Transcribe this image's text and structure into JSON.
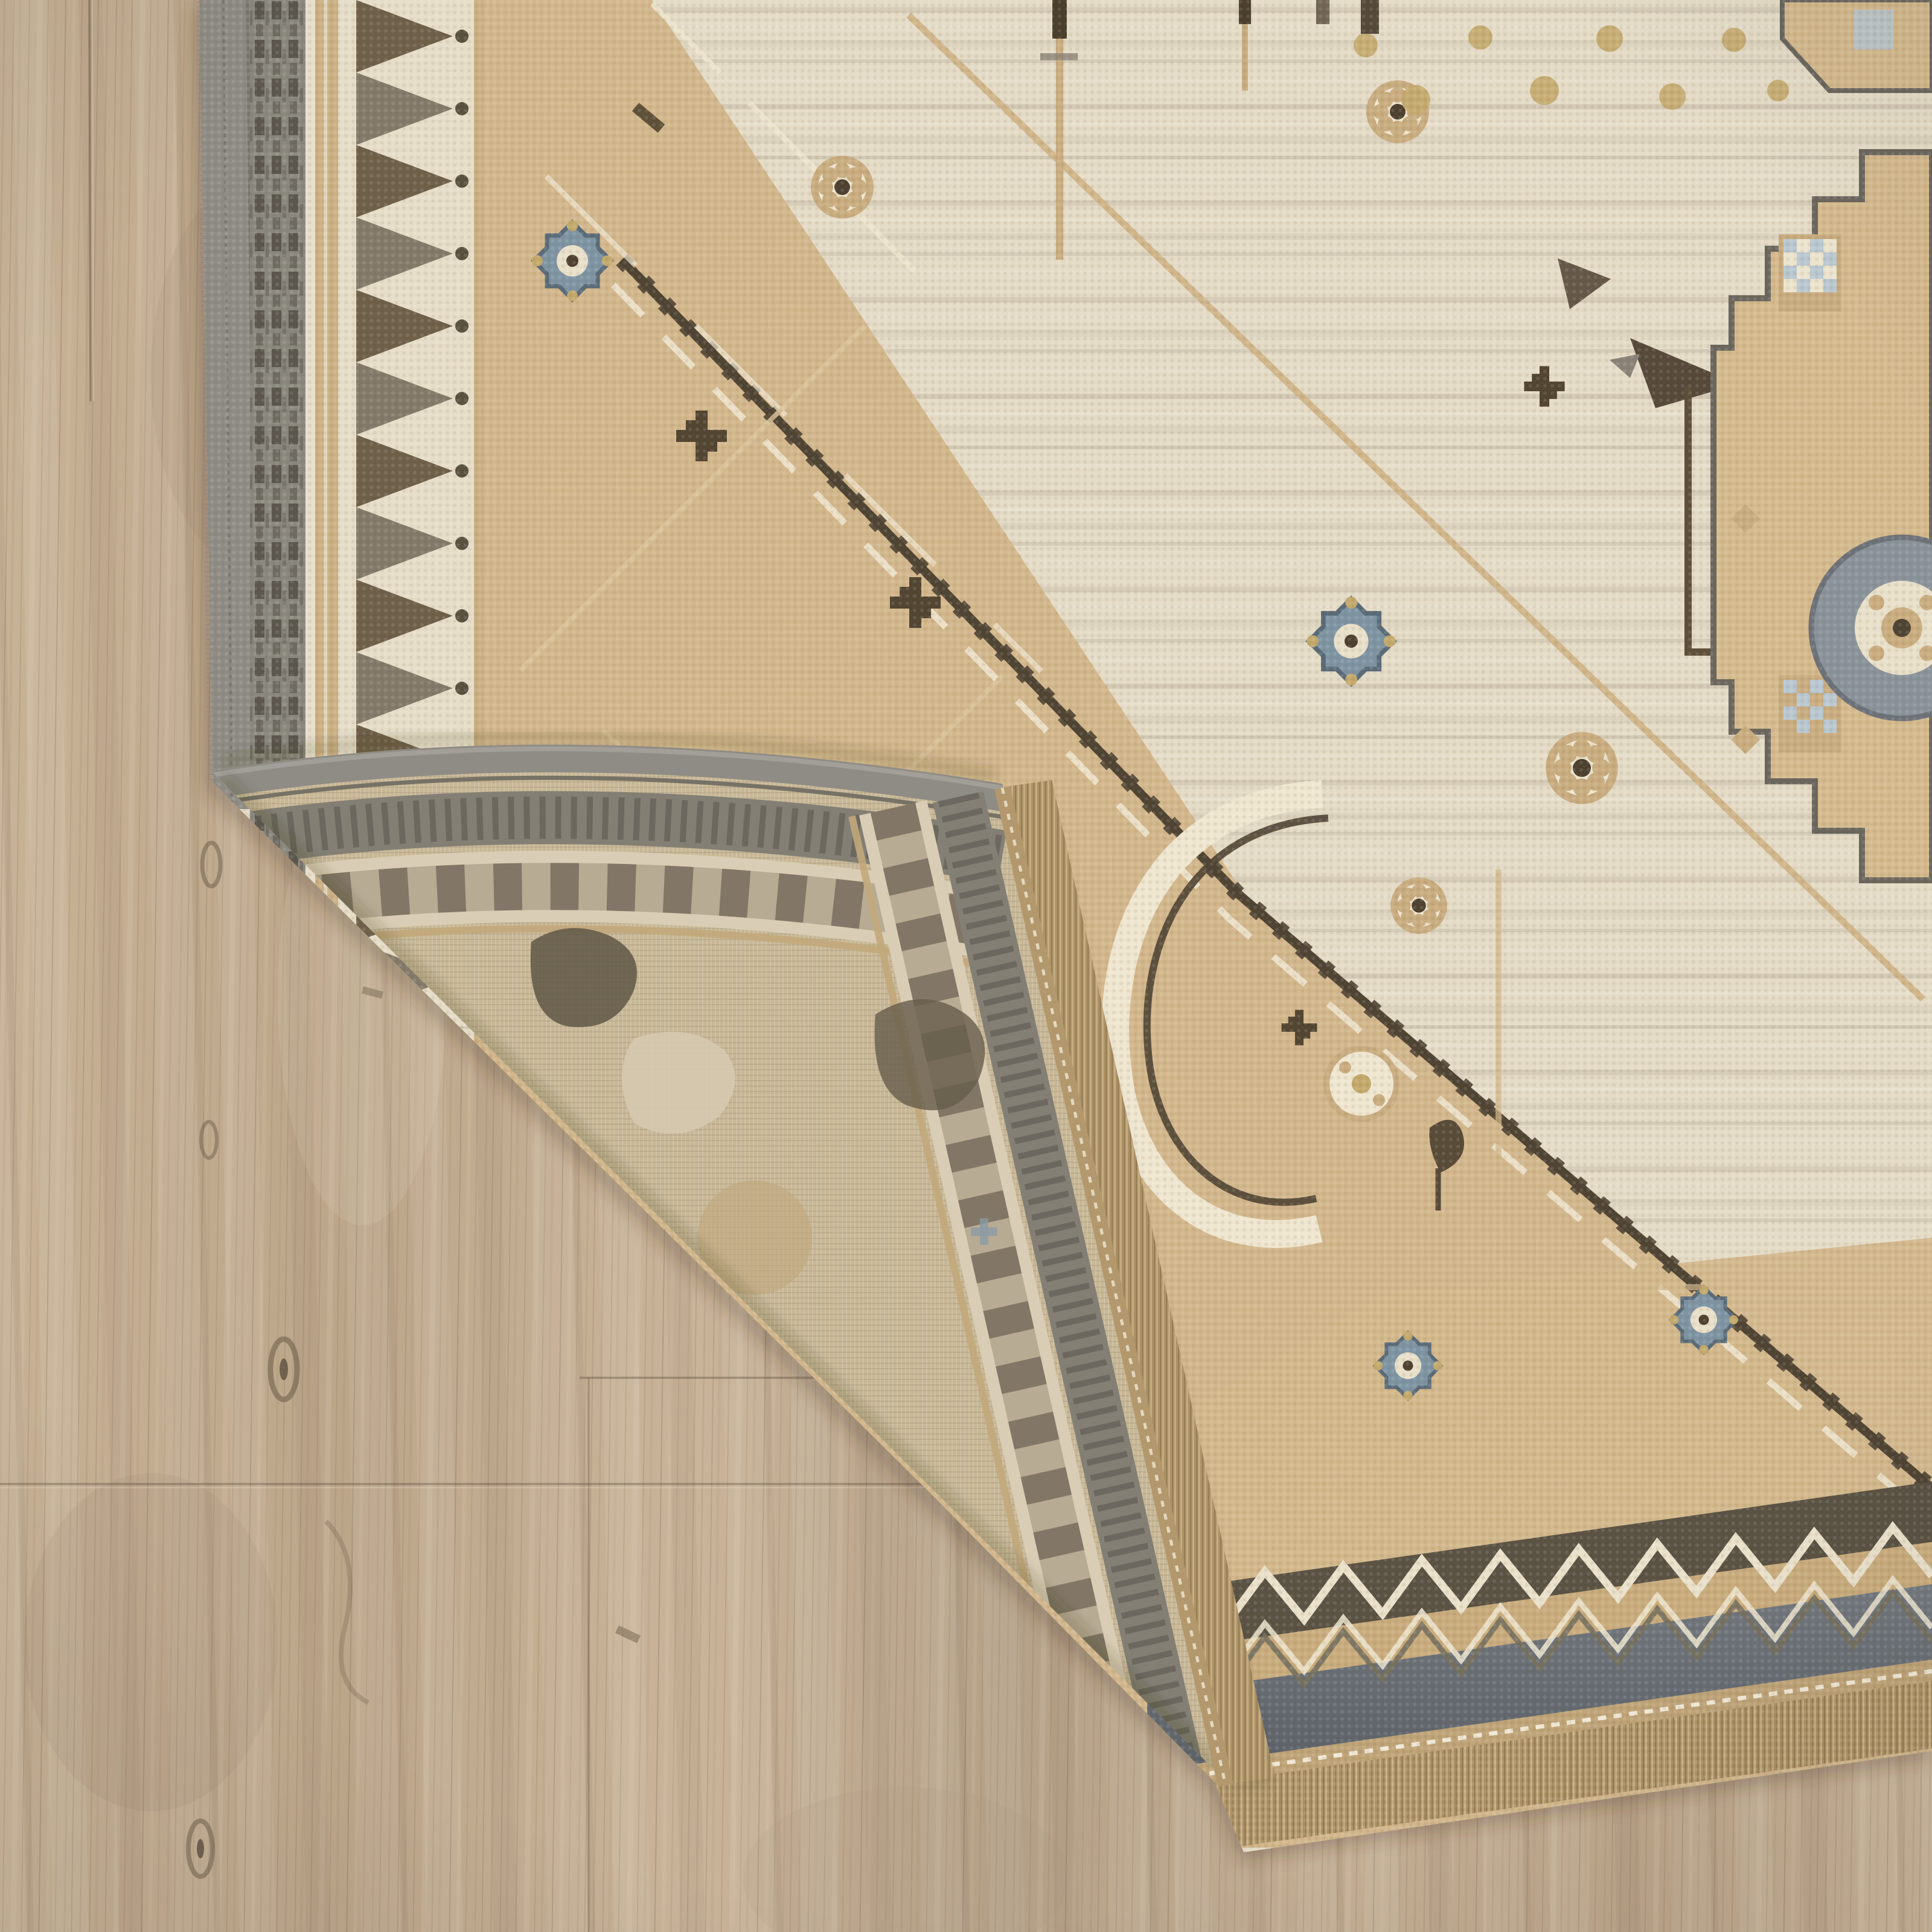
{
  "scene": {
    "type": "product-photograph",
    "subject": "Beige ivory and tan oriental area rug with bottom-left corner folded over, revealing muted reverse weave, gray serged edge and tan fringe, on a light oak wood plank floor",
    "caption": "Rug corner folded showing front pile, woven back, serged side edge and fringed end over wood flooring",
    "rug": {
      "front_face": "knotted pile, ivory field with tan diagonal bands, brown zigzag diagonals, rosette and bird-on-pole motifs, stepped tan medallion at right edge",
      "back_face": "flat muted weave of same border pattern on folded corner",
      "side_edge": "gray serged binding",
      "end_edge": "tan selvage with white stitch dots and tan fringe",
      "borders": [
        "gray striped outer band",
        "ivory band with brown triangle zigzag",
        "slate gray band",
        "dark band with ivory chevron"
      ]
    },
    "floor": {
      "material": "light oak style planks",
      "grain": "vertical streaked grain with knots and seams"
    }
  },
  "colors": {
    "wood-base1": "#c7b296",
    "wood-base2": "#bca68a",
    "wood-base3": "#c9b499",
    "wood-base4": "#b5a188",
    "wood-base5": "#c3ae93",
    "wood-seam": "#5e4f3e",
    "wood-knot": "#6f604c",
    "rug-ivory": "#e4dbc6",
    "rug-tan": "#d3b78c",
    "rug-gold": "#c3a96c",
    "rug-brown": "#4f4433",
    "rug-umber": "#6b5d45",
    "rug-graybrown": "#7e7565",
    "rug-bluegray": "#7e94a3",
    "rug-blue-dark": "#5a6b78",
    "rug-white": "#efe6d0",
    "serge-gray": "#8f8c85",
    "border-gray": "#8b887e",
    "border-dash": "#5b574e",
    "dark-band": "#5a5243",
    "slate-band": "#5b6167",
    "slate-band-light": "#747a80",
    "selvage-tan": "#bfa478",
    "fringe-tan": "#b49a6e",
    "fringe-dark": "#967c52",
    "fringe-light": "#cdb488",
    "flap-base": "#c7b796",
    "flap-ivory": "#dacdb5",
    "flap-gray": "#837f74",
    "flap-dark": "#6b6152",
    "flap-tan": "#c2a87b",
    "flap-field-tan": "#bfa67c",
    "flap-blob": "#5f5746",
    "flap-blue": "#8a9aa6",
    "medallion-tan": "#d5ba8e",
    "medallion-line": "#6b675d",
    "checker-blue": "#b9c7d0",
    "checker-ivory": "#ebe3cd"
  },
  "elements": [
    "wood-floor",
    "plank-seams",
    "wood-knots",
    "rug-shadow",
    "area-rug-front",
    "rug-left-border",
    "rug-field-diagonals",
    "rosette-motifs",
    "blue-rosette-motifs",
    "bird-on-pole-motif",
    "right-edge-medallion",
    "rug-bottom-border",
    "rug-bottom-fringe",
    "folded-corner-back",
    "flap-serged-edge",
    "flap-border-bands",
    "flap-fringe"
  ]
}
